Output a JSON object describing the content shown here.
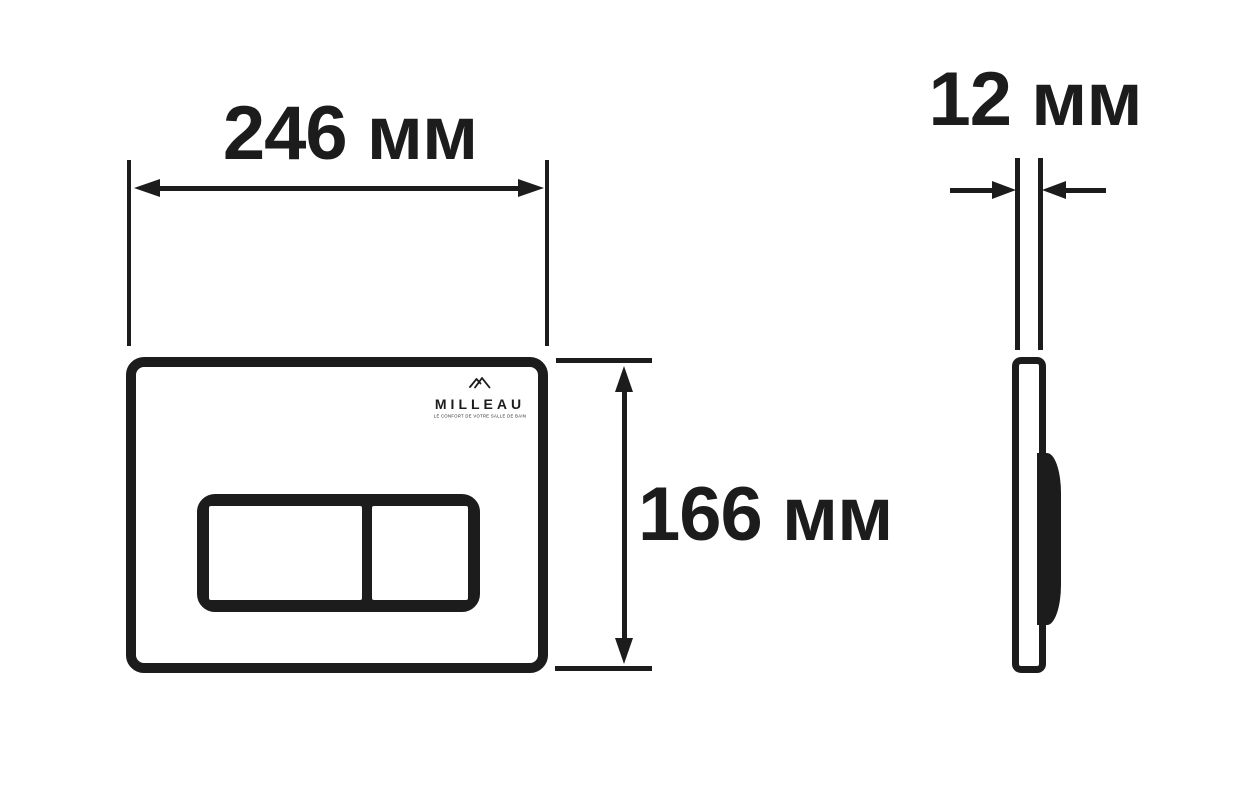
{
  "colors": {
    "ink": "#1c1c1c",
    "background": "#ffffff"
  },
  "front_view": {
    "width_dimension_label": "246 мм",
    "height_dimension_label": "166 мм",
    "logo": {
      "brand": "MILLEAU",
      "tagline": "LE CONFORT DE VOTRE SALLE DE BAIN",
      "icon": "mountain-icon"
    }
  },
  "side_view": {
    "thickness_dimension_label": "12 мм"
  }
}
